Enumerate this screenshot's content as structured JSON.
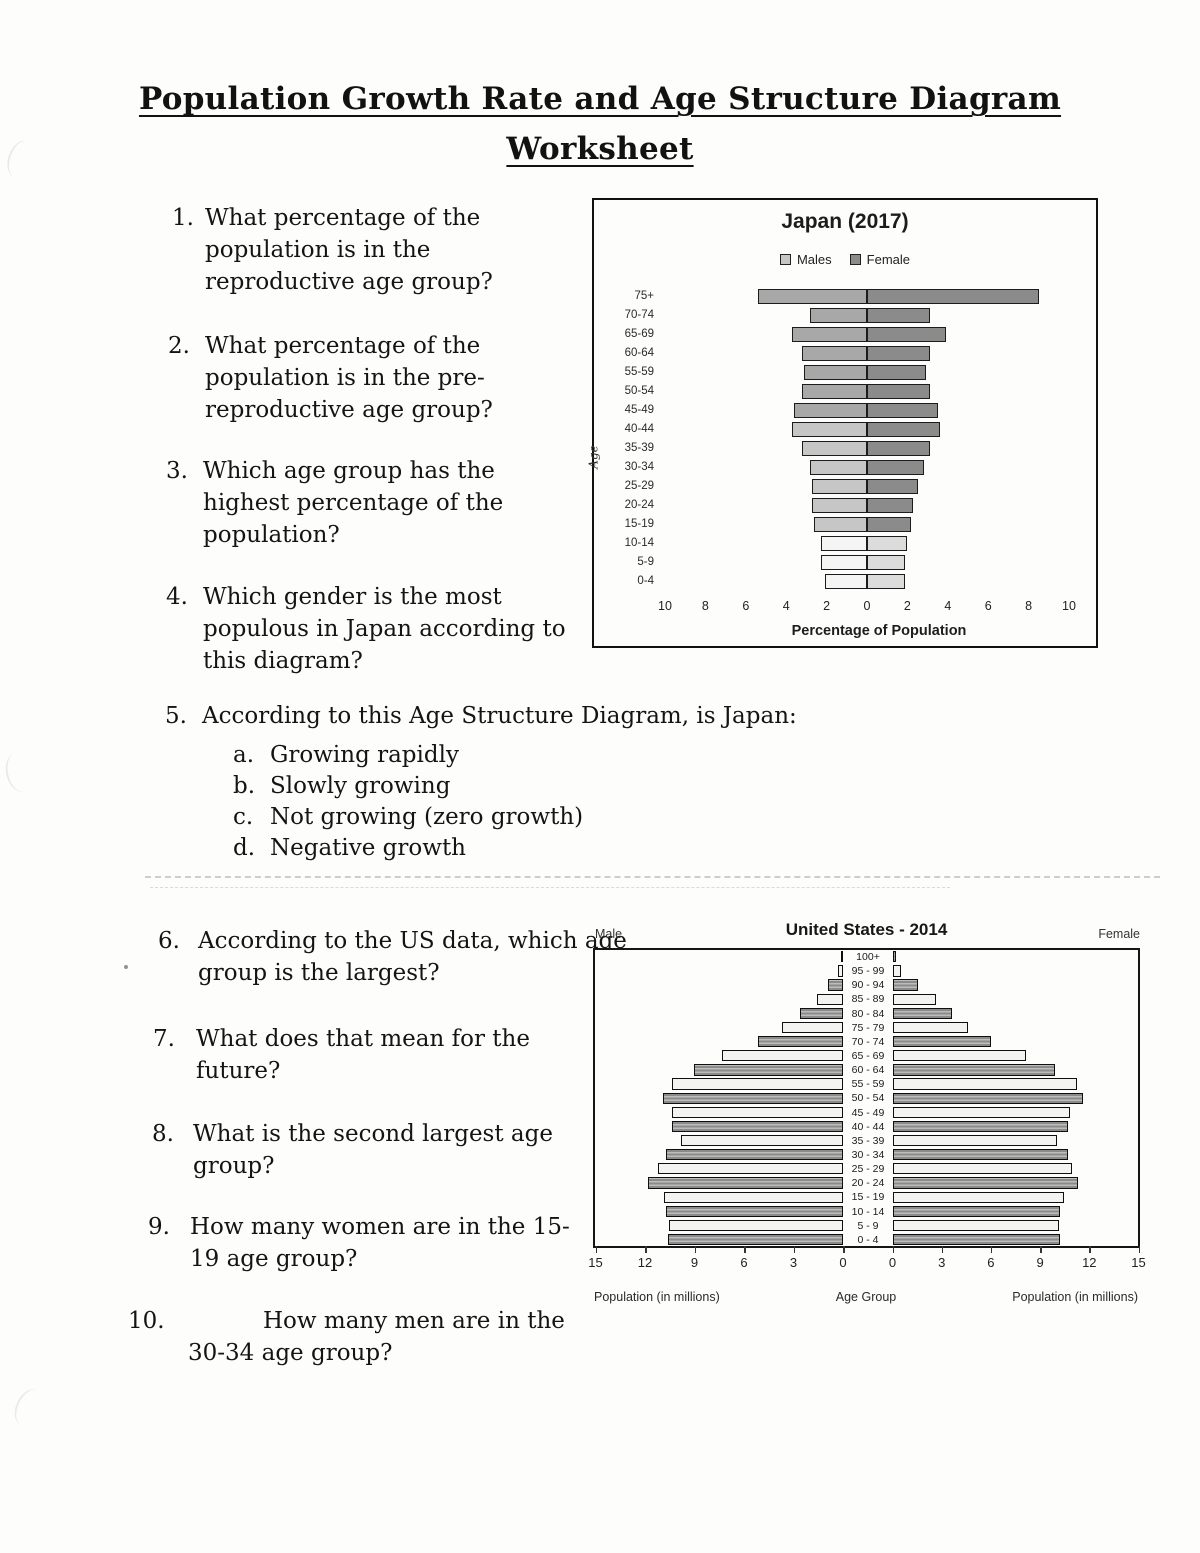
{
  "page_title": {
    "line1": "Population Growth Rate and Age Structure Diagram",
    "line2": "Worksheet"
  },
  "questions": [
    {
      "num": "1.",
      "text": "What percentage of the population is in the reproductive age group?"
    },
    {
      "num": "2.",
      "text": "What percentage of the population is in the pre-reproductive age group?"
    },
    {
      "num": "3.",
      "text": "Which age group has the highest percentage of the population?"
    },
    {
      "num": "4.",
      "text": "Which gender is the most populous in Japan according to this diagram?"
    },
    {
      "num": "5.",
      "text": "According to this Age Structure Diagram, is Japan:",
      "options": [
        {
          "letter": "a.",
          "text": "Growing rapidly"
        },
        {
          "letter": "b.",
          "text": "Slowly growing"
        },
        {
          "letter": "c.",
          "text": "Not growing (zero growth)"
        },
        {
          "letter": "d.",
          "text": "Negative growth"
        }
      ]
    },
    {
      "num": "6.",
      "text": "According to the US data, which age group is the largest?"
    },
    {
      "num": "7.",
      "text": "What does that mean for the future?"
    },
    {
      "num": "8.",
      "text": "What is the second largest age group?"
    },
    {
      "num": "9.",
      "text": "How many women are in the 15-19 age group?"
    },
    {
      "num": "10.",
      "text": "How many men are in the 30-34 age group?"
    }
  ],
  "chart_data": [
    {
      "id": "japan-pyramid",
      "type": "bar",
      "subtype": "population-pyramid",
      "title": "Japan (2017)",
      "legend": [
        {
          "label": "Males",
          "color": "#c6c6c6"
        },
        {
          "label": "Female",
          "color": "#8b8b8b"
        }
      ],
      "ylabel": "Age",
      "xlabel": "Percentage of Population",
      "x_tick_labels": [
        "10",
        "8",
        "6",
        "4",
        "2",
        "0",
        "2",
        "4",
        "6",
        "8",
        "10"
      ],
      "xlim_pct_each_side": [
        0,
        10
      ],
      "categories": [
        "75+",
        "70-74",
        "65-69",
        "60-64",
        "55-59",
        "50-54",
        "45-49",
        "40-44",
        "35-39",
        "30-34",
        "25-29",
        "20-24",
        "15-19",
        "10-14",
        "5-9",
        "0-4"
      ],
      "series": [
        {
          "name": "Males",
          "values": [
            5.4,
            2.8,
            3.7,
            3.2,
            3.1,
            3.2,
            3.6,
            3.7,
            3.2,
            2.8,
            2.7,
            2.7,
            2.6,
            2.3,
            2.3,
            2.1
          ],
          "fills": [
            "#a8a8a8",
            "#a8a8a8",
            "#a8a8a8",
            "#a8a8a8",
            "#a8a8a8",
            "#a8a8a8",
            "#a8a8a8",
            "#c6c6c6",
            "#c6c6c6",
            "#c6c6c6",
            "#c6c6c6",
            "#c6c6c6",
            "#c6c6c6",
            "#f5f5f5",
            "#f5f5f5",
            "#f5f5f5"
          ]
        },
        {
          "name": "Female",
          "values": [
            8.5,
            3.1,
            3.9,
            3.1,
            2.9,
            3.1,
            3.5,
            3.6,
            3.1,
            2.8,
            2.5,
            2.3,
            2.2,
            2.0,
            1.9,
            1.9
          ],
          "fills": [
            "#8b8b8b",
            "#8b8b8b",
            "#8b8b8b",
            "#8b8b8b",
            "#8b8b8b",
            "#8b8b8b",
            "#8b8b8b",
            "#8b8b8b",
            "#8b8b8b",
            "#8b8b8b",
            "#8b8b8b",
            "#8b8b8b",
            "#8b8b8b",
            "#dcdcdc",
            "#dcdcdc",
            "#dcdcdc"
          ]
        }
      ]
    },
    {
      "id": "us-pyramid",
      "type": "bar",
      "subtype": "population-pyramid",
      "title": "United States - 2014",
      "left_header": "Male",
      "right_header": "Female",
      "xlabel_left": "Population (in millions)",
      "xlabel_center": "Age Group",
      "xlabel_right": "Population (in millions)",
      "x_ticks_left": [
        "15",
        "12",
        "9",
        "6",
        "3",
        "0"
      ],
      "x_ticks_right": [
        "0",
        "3",
        "6",
        "9",
        "12",
        "15"
      ],
      "xlim_millions_each_side": [
        0,
        15
      ],
      "categories": [
        "100+",
        "95 - 99",
        "90 - 94",
        "85 - 89",
        "80 - 84",
        "75 - 79",
        "70 - 74",
        "65 - 69",
        "60 - 64",
        "55 - 59",
        "50 - 54",
        "45 - 49",
        "40 - 44",
        "35 - 39",
        "30 - 34",
        "25 - 29",
        "20 - 24",
        "15 - 19",
        "10 - 14",
        "5 - 9",
        "0 - 4"
      ],
      "series": [
        {
          "name": "Male",
          "values": [
            0.1,
            0.3,
            0.9,
            1.6,
            2.6,
            3.7,
            5.2,
            7.4,
            9.1,
            10.4,
            11.0,
            10.4,
            10.4,
            9.9,
            10.8,
            11.3,
            11.9,
            10.9,
            10.8,
            10.6,
            10.7
          ]
        },
        {
          "name": "Female",
          "values": [
            0.2,
            0.5,
            1.5,
            2.6,
            3.6,
            4.6,
            6.0,
            8.1,
            9.9,
            11.2,
            11.6,
            10.8,
            10.7,
            10.0,
            10.7,
            10.9,
            11.3,
            10.4,
            10.2,
            10.1,
            10.2
          ]
        }
      ],
      "row_pattern": [
        "dark",
        "light",
        "dark",
        "light",
        "dark",
        "light",
        "dark",
        "light",
        "dark",
        "light",
        "dark",
        "light",
        "dark",
        "light",
        "dark",
        "light",
        "dark",
        "light",
        "dark",
        "light",
        "dark"
      ],
      "pattern_colors": {
        "dark_stripe_a": "#8b8b8b",
        "dark_stripe_b": "#bdbdbd",
        "light_fill": "#f3f3f1"
      }
    }
  ]
}
